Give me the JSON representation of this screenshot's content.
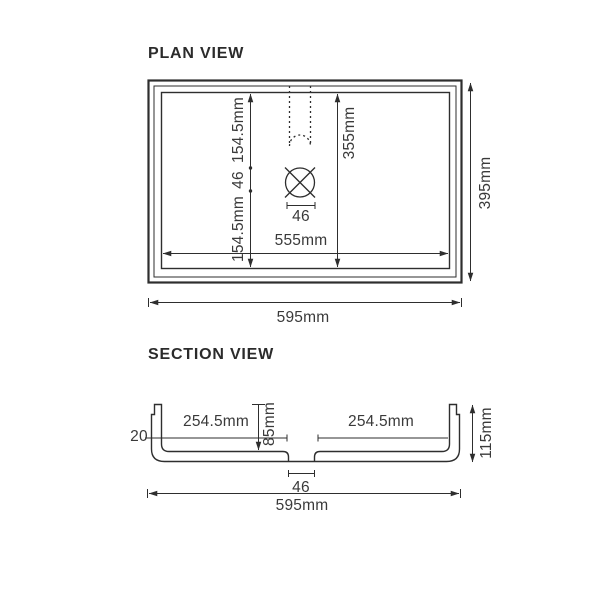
{
  "plan": {
    "title": "PLAN VIEW",
    "dims": {
      "seg_top": "154.5mm",
      "seg_mid": "46",
      "seg_bottom": "154.5mm",
      "bowl_width": "355mm",
      "waste_width": "46",
      "bowl_length": "555mm",
      "overall_length": "595mm",
      "overall_width": "395mm"
    }
  },
  "section": {
    "title": "SECTION VIEW",
    "dims": {
      "edge_thickness": "20",
      "left_span": "254.5mm",
      "bowl_depth": "85mm",
      "right_span": "254.5mm",
      "overall_height": "115mm",
      "waste_width": "46",
      "overall_length": "595mm"
    }
  },
  "colors": {
    "line": "#2e2e2e",
    "text": "#3a3a3a",
    "background": "#ffffff"
  }
}
